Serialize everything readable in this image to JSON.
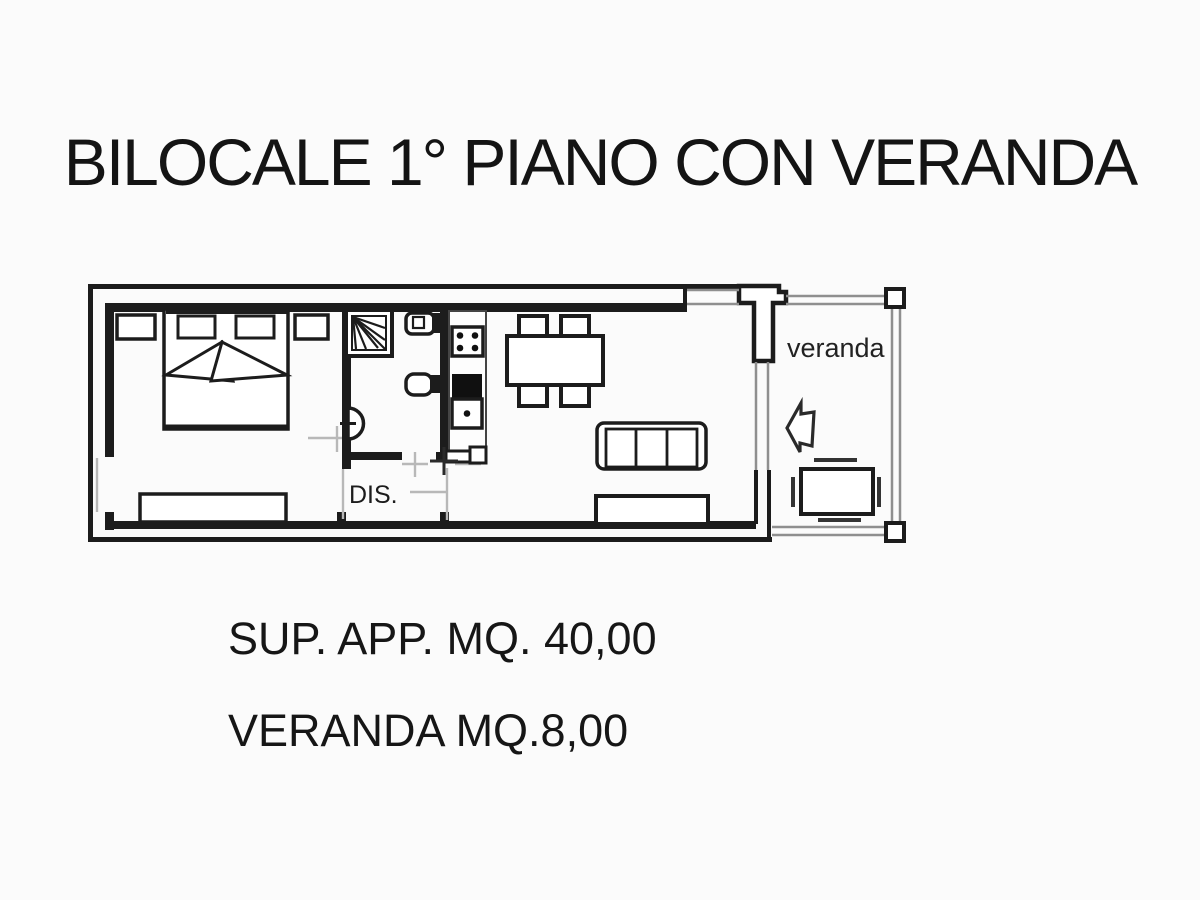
{
  "title": "BILOCALE 1° PIANO CON VERANDA",
  "floor_plan": {
    "room_labels": {
      "hallway": "DIS.",
      "veranda": "veranda"
    }
  },
  "captions": {
    "apartment_area": "SUP. APP. MQ. 40,00",
    "veranda_area": "VERANDA MQ.8,00"
  },
  "colors": {
    "ink": "#1c1c1c",
    "thin_outline": "#8f8f8f",
    "door_mark": "#b8b8b8",
    "background": "#fbfbfb"
  }
}
